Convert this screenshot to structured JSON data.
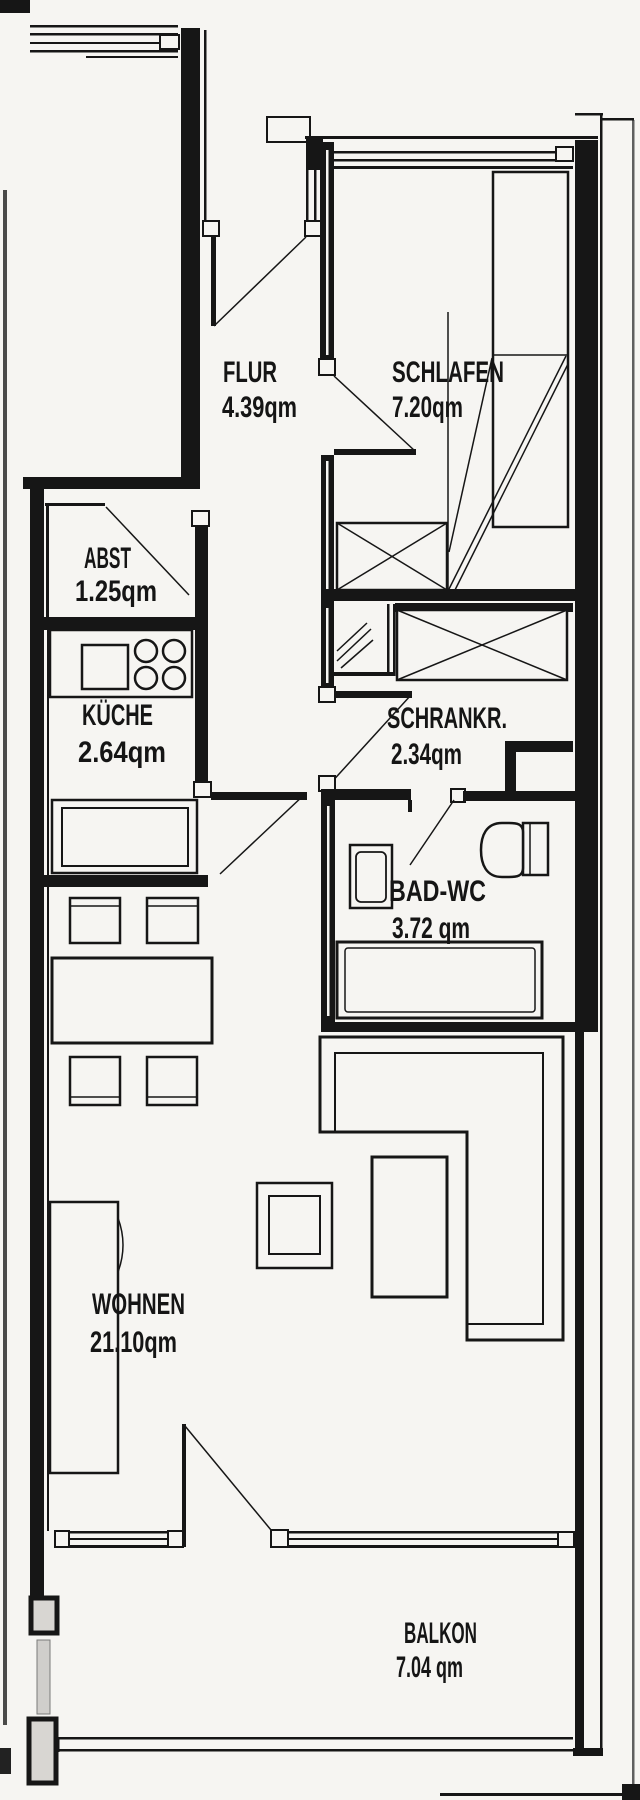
{
  "plan": {
    "title": "apartment-floor-plan",
    "area_unit": "qm",
    "rooms": [
      {
        "name": "FLUR",
        "area": "4.39qm"
      },
      {
        "name": "SCHLAFEN",
        "area": "7.20qm"
      },
      {
        "name": "ABST",
        "area": "1.25qm"
      },
      {
        "name": "KÜCHE",
        "area": "2.64qm"
      },
      {
        "name": "SCHRANKR.",
        "area": "2.34qm"
      },
      {
        "name": "BAD-WC",
        "area": "3.72 qm"
      },
      {
        "name": "WOHNEN",
        "area": "21.10qm"
      },
      {
        "name": "BALKON",
        "area": "7.04 qm"
      }
    ],
    "colors": {
      "paper": "#f6f5f2",
      "ink": "#161616"
    }
  }
}
